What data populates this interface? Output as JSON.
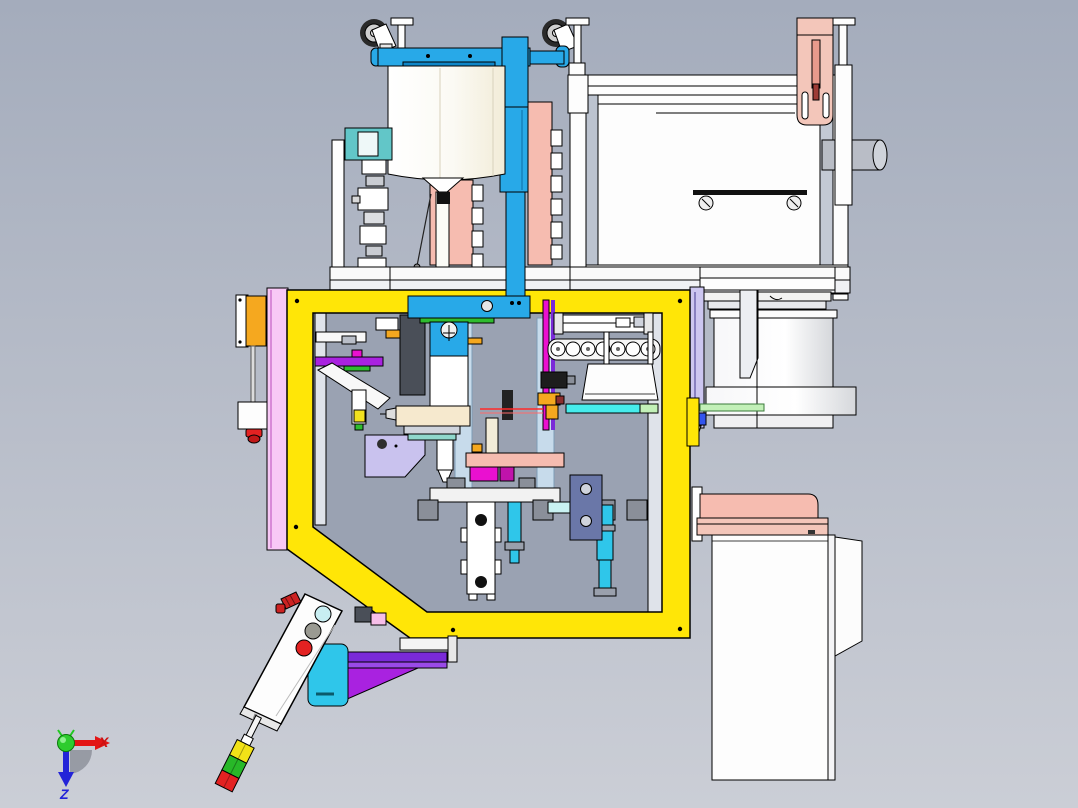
{
  "app": {
    "title": "3D CAD assembly viewport",
    "view_note": "orthographic side view of automated dispensing machine, flipped (casters up)"
  },
  "axis_triad": {
    "x_label": "X",
    "z_label": "Z",
    "x_color": "#e31515",
    "z_color": "#2323d8",
    "origin_color": "#22c822"
  },
  "colors": {
    "bg_top": "#a4acbc",
    "bg_bottom": "#cbced6",
    "frame_yellow": "#ffe607",
    "blue": "#28a9e8",
    "blue_dark": "#0e86c8",
    "salmon": "#f6bcb0",
    "salmon_light": "#f3c6ba",
    "pink_plate": "#f8c8f6",
    "lavender": "#ccc6f0",
    "lavender_bracket": "#c9c2ee",
    "magenta": "#ea10d0",
    "violet": "#7a2ad8",
    "purple": "#a922e0",
    "cyan_bright": "#2fc6ea",
    "cyan_pale": "#c9f2f2",
    "cyan_strip": "#46ecec",
    "teal": "#62c6c8",
    "orange": "#f5a81f",
    "green": "#2fbc2f",
    "green_pale": "#c2f0b8",
    "red": "#e32222",
    "slate": "#6a77a8",
    "ivory": "#f2ecd8",
    "white_part": "#fdfdfd",
    "gray_part": "#9aa0ac",
    "gray_dark": "#4a4f58",
    "window_gray": "#9aa2b2"
  },
  "parts_legend": [
    {
      "name": "caster-gantry-beam",
      "color": "#28a9e8"
    },
    {
      "name": "swivel-casters",
      "color": "#2a2a2a"
    },
    {
      "name": "leveling-feet",
      "color": "#fdfdfd"
    },
    {
      "name": "mixing-tank",
      "color": "#f2ecd8"
    },
    {
      "name": "cable-clamp-plates",
      "color": "#f6bcb0"
    },
    {
      "name": "electrical-enclosure",
      "color": "#fdfdfd"
    },
    {
      "name": "safety-frame",
      "color": "#ffe607"
    },
    {
      "name": "side-shield-plate",
      "color": "#f8c8f6"
    },
    {
      "name": "dispense-head",
      "color": "#28a9e8"
    },
    {
      "name": "guide-columns",
      "color": "#c9e6f8"
    },
    {
      "name": "cable-chain",
      "color": "#ffffff"
    },
    {
      "name": "parts-tray",
      "color": "#fdfdfd"
    },
    {
      "name": "conveyor-strip",
      "color": "#46ecec"
    },
    {
      "name": "linear-rail",
      "color": "#ccc6f0"
    },
    {
      "name": "bowl-feeder-drum",
      "color": "#fdfdfd"
    },
    {
      "name": "mount-beam",
      "color": "#f6bcb0"
    },
    {
      "name": "control-cabinet",
      "color": "#fdfdfd"
    },
    {
      "name": "pendant-station",
      "color": "#fdfdfd"
    },
    {
      "name": "pendant-buttons",
      "color": "#c8eef2 / #9a9a92 / #e32222"
    },
    {
      "name": "signal-tower",
      "color": "#f2e217 / #28b828 / #e32222"
    },
    {
      "name": "gusset-bracket",
      "color": "#a922e0"
    },
    {
      "name": "laser-beam",
      "color": "#ff2a2a"
    }
  ]
}
